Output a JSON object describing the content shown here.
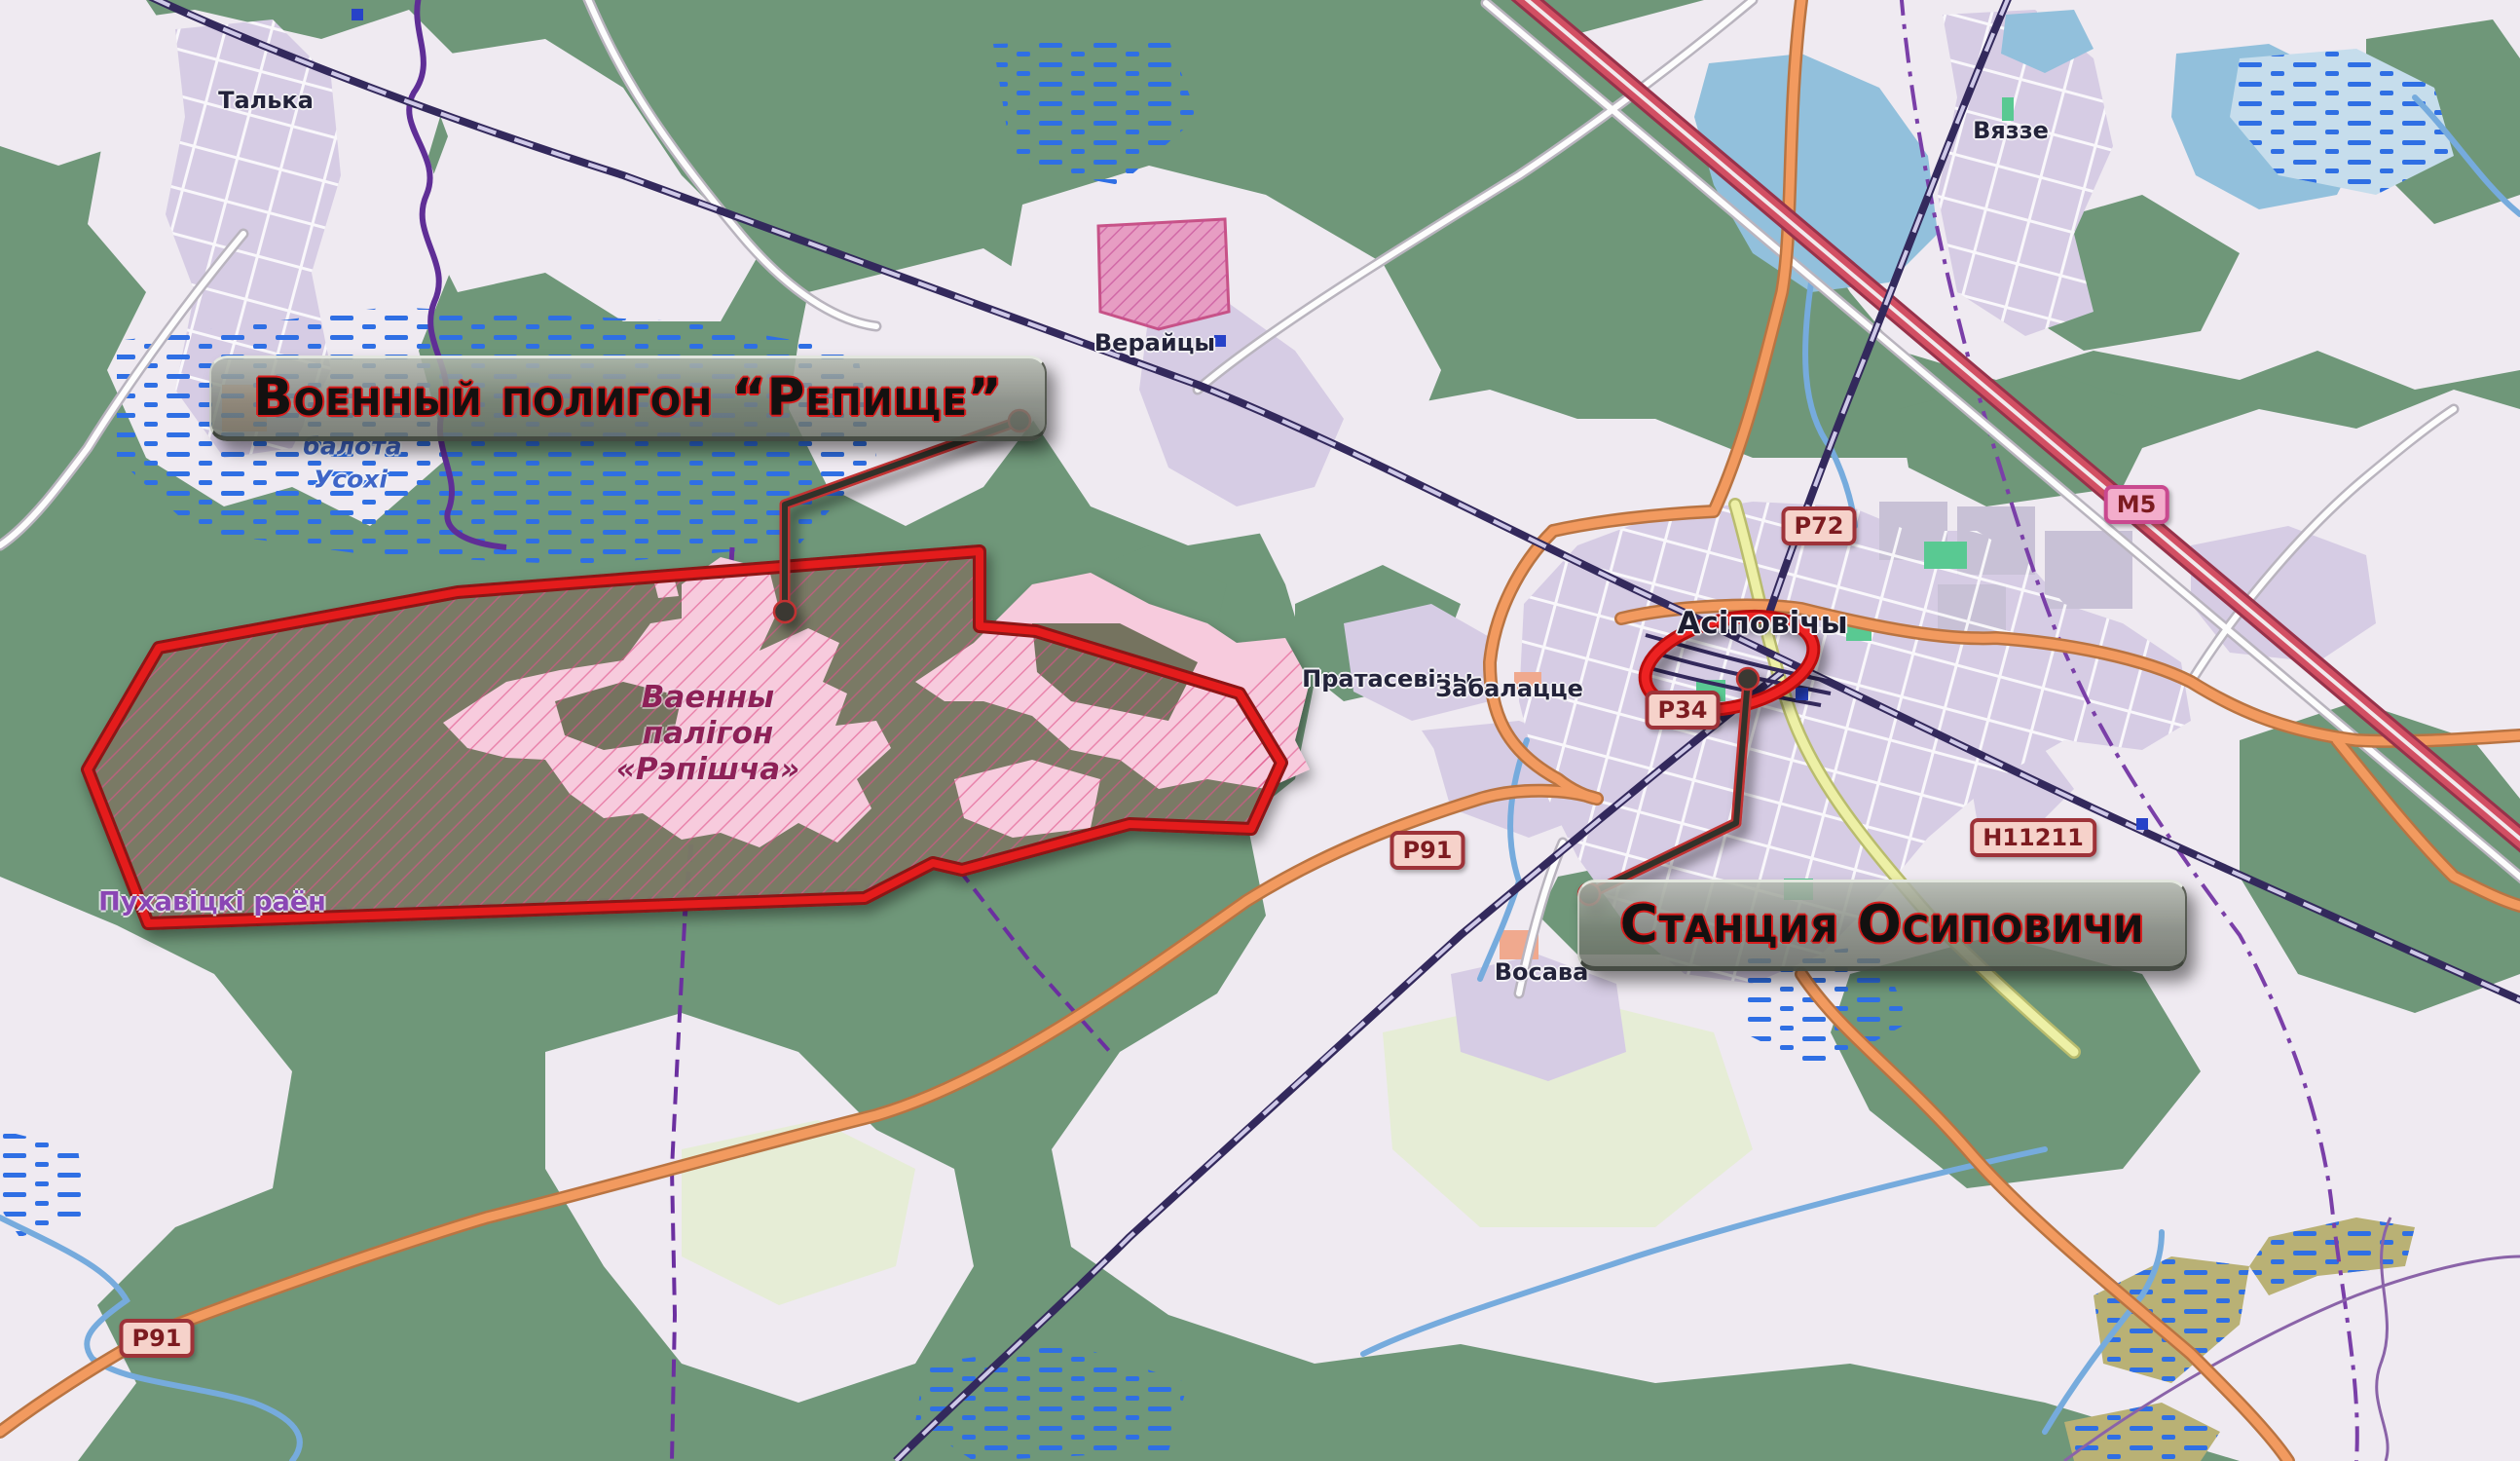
{
  "annotations": {
    "military_label": "Военный полигон “Репище”",
    "station_label": "Станция Осиповичи"
  },
  "map_labels": {
    "talka": "Талька",
    "vieraitsy": "Верайцы",
    "viazze": "Вяззе",
    "asipovichy": "Асіповічы",
    "pratasevichy": "Пратасевічы",
    "zabalacce": "Забалацце",
    "vosava": "Восава",
    "district": "Пухавіцкі раён",
    "swamp_line1": "балота",
    "swamp_line2": "Усохі",
    "range_line1": "Ваенны",
    "range_line2": "палігон",
    "range_line3": "«Рэпішча»"
  },
  "road_shields": {
    "m5": "М5",
    "p72": "Р72",
    "p34": "Р34",
    "p91": "Р91",
    "h11211": "Н11211"
  },
  "colors": {
    "forest_green": "#6f9779",
    "field_light": "#efeaf1",
    "urban_lavender": "#d6cce4",
    "water_blue": "#92c0dc",
    "marsh_dash_blue": "#2f6fe4",
    "military_fill": "#7b7a65",
    "military_pink": "#f7cbdd",
    "annotation_red": "#e01515",
    "leader_dark": "#33302b",
    "road_orange": "#f29a5f",
    "motorway_red": "#d24f63",
    "boundary_purple": "#7a3fa8"
  }
}
